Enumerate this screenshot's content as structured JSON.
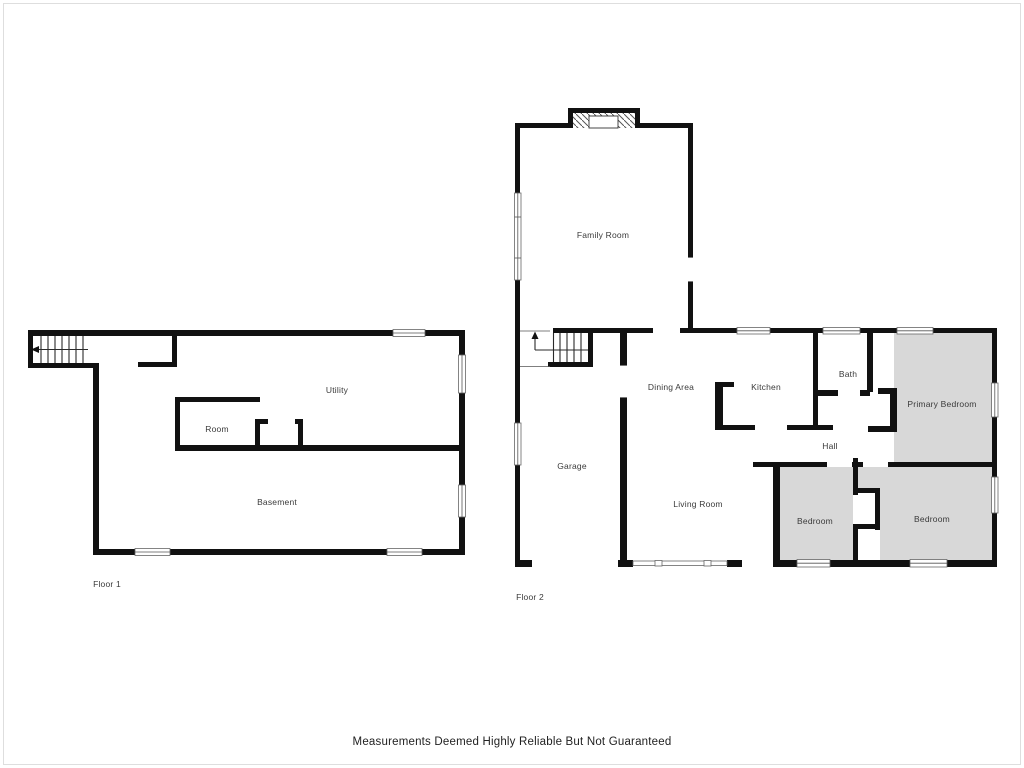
{
  "title": "Residential Floor Plan",
  "disclaimer": "Measurements Deemed Highly Reliable But Not Guaranteed",
  "colors": {
    "wall": "#111111",
    "room_fill": "#d8d8d8",
    "label": "#3a3a3a",
    "frame": "#dedede"
  },
  "floors": [
    {
      "caption": "Floor 1",
      "caption_pos": {
        "x": 107,
        "y": 584
      },
      "rooms": [
        {
          "label": "Utility",
          "x": 337,
          "y": 390
        },
        {
          "label": "Room",
          "x": 217,
          "y": 429
        },
        {
          "label": "Basement",
          "x": 277,
          "y": 502
        }
      ]
    },
    {
      "caption": "Floor 2",
      "caption_pos": {
        "x": 530,
        "y": 597
      },
      "rooms": [
        {
          "label": "Family Room",
          "x": 603,
          "y": 235
        },
        {
          "label": "Dining Area",
          "x": 671,
          "y": 387
        },
        {
          "label": "Kitchen",
          "x": 766,
          "y": 387
        },
        {
          "label": "Bath",
          "x": 848,
          "y": 374
        },
        {
          "label": "Garage",
          "x": 572,
          "y": 466
        },
        {
          "label": "Hall",
          "x": 830,
          "y": 446
        },
        {
          "label": "Living Room",
          "x": 698,
          "y": 504
        },
        {
          "label": "Bedroom",
          "x": 815,
          "y": 521
        },
        {
          "label": "Bedroom",
          "x": 932,
          "y": 519
        },
        {
          "label": "Primary Bedroom",
          "x": 942,
          "y": 404
        }
      ]
    }
  ],
  "icons": [
    {
      "name": "stairs-down-arrow-icon",
      "floor": "Floor 1",
      "direction": "left"
    },
    {
      "name": "stairs-up-arrow-icon",
      "floor": "Floor 2",
      "direction": "up"
    }
  ]
}
